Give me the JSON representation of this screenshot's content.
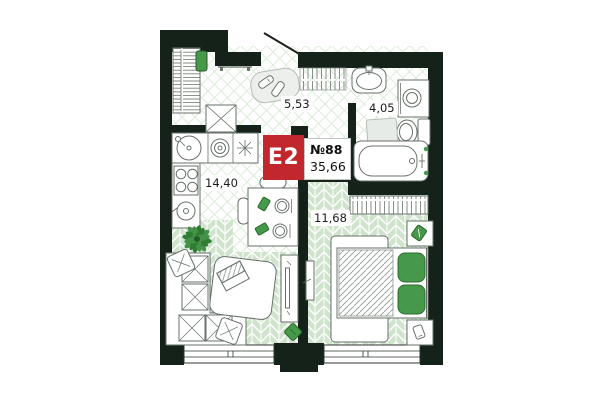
{
  "plan": {
    "unit_badge": "E2",
    "unit_number": "№88",
    "total_area": "35,66",
    "rooms": {
      "hallway": {
        "area": "5,53"
      },
      "bathroom": {
        "area": "4,05"
      },
      "kitchen_living": {
        "area": "14,40"
      },
      "bedroom": {
        "area": "11,68"
      }
    },
    "colors": {
      "wall": "#142219",
      "accent_green": "#46984a",
      "accent_green_dark": "#2c6b30",
      "badge_red": "#c2272d",
      "floor_plank_green": "#cfe3cd",
      "floor_lattice_green": "#ddecd9"
    }
  }
}
